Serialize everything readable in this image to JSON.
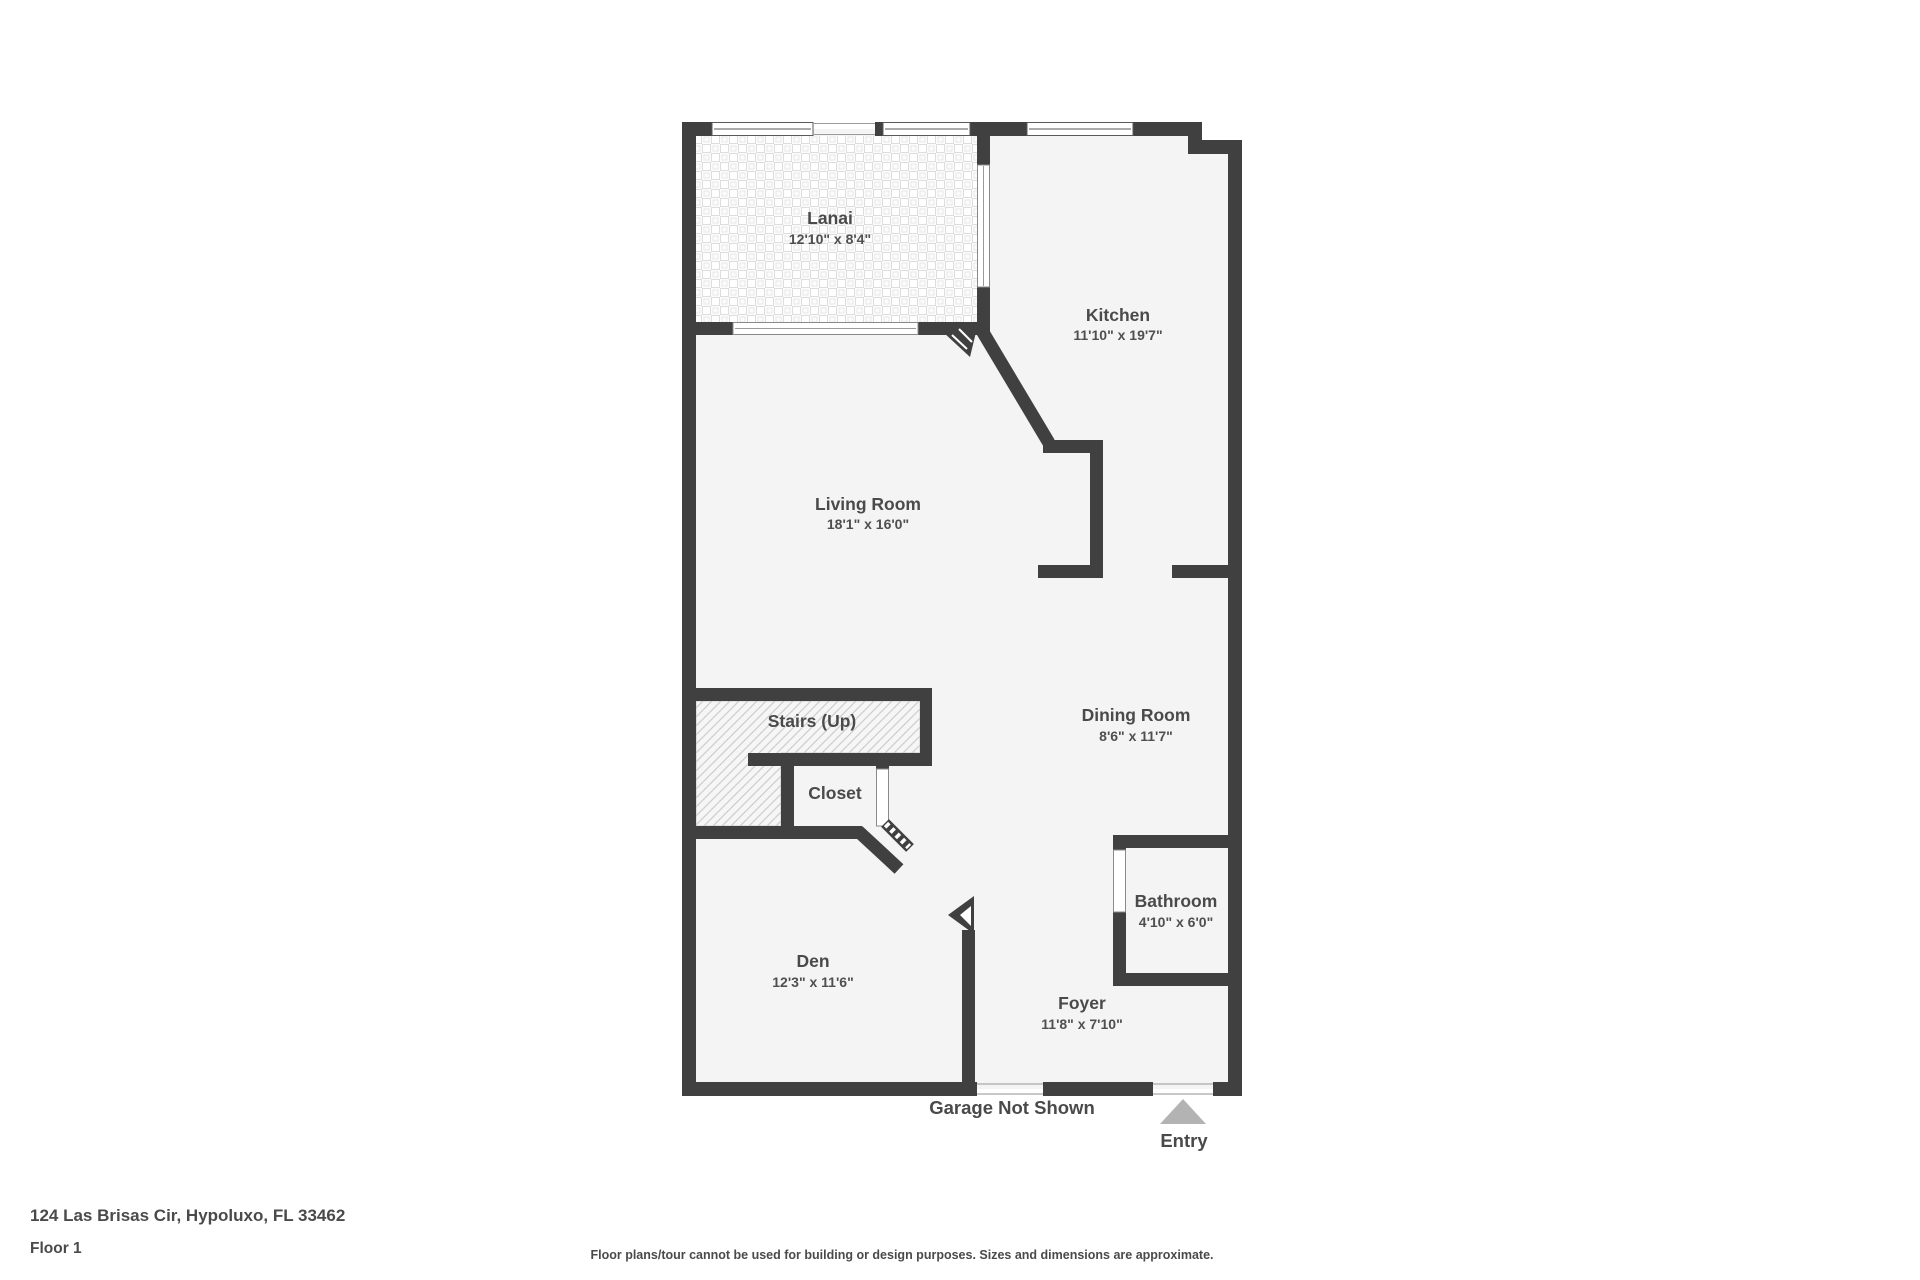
{
  "rooms": {
    "lanai": {
      "name": "Lanai",
      "dims": "12'10\" x 8'4\""
    },
    "kitchen": {
      "name": "Kitchen",
      "dims": "11'10\" x 19'7\""
    },
    "living_room": {
      "name": "Living Room",
      "dims": "18'1\" x 16'0\""
    },
    "dining_room": {
      "name": "Dining Room",
      "dims": "8'6\" x 11'7\""
    },
    "stairs": {
      "name": "Stairs (Up)"
    },
    "closet": {
      "name": "Closet"
    },
    "bathroom": {
      "name": "Bathroom",
      "dims": "4'10\" x 6'0\""
    },
    "den": {
      "name": "Den",
      "dims": "12'3\" x 11'6\""
    },
    "foyer": {
      "name": "Foyer",
      "dims": "11'8\" x 7'10\""
    }
  },
  "annotations": {
    "garage_note": "Garage Not Shown",
    "entry": "Entry"
  },
  "footer": {
    "address": "124 Las Brisas Cir, Hypoluxo, FL 33462",
    "floor": "Floor 1",
    "disclaimer": "Floor plans/tour cannot be used for building or design purposes. Sizes and dimensions are approximate."
  },
  "colors": {
    "wall": "#404040",
    "floor": "#f4f4f4",
    "text": "#4a4a4a",
    "entry_arrow": "#b3b3b3",
    "stairs_hatch_line": "#cfcfcf",
    "tile_line": "#e0e0e0"
  }
}
